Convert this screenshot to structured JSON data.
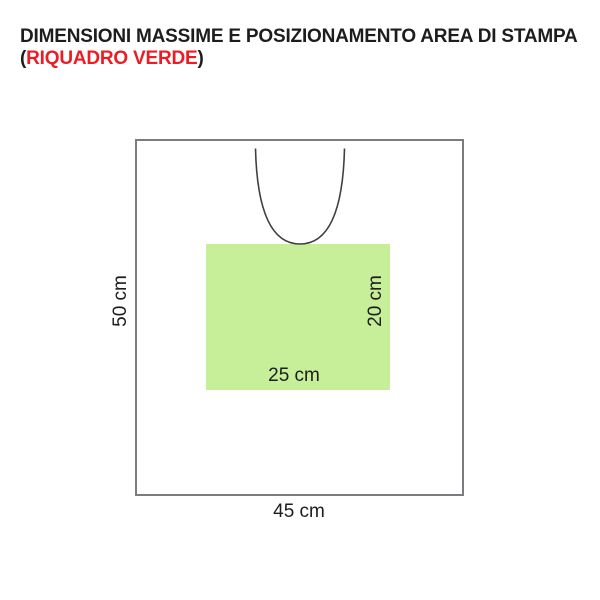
{
  "title": {
    "line1": "DIMENSIONI MASSIME E POSIZIONAMENTO AREA DI STAMPA",
    "line2_open": "(",
    "line2_highlight": "RIQUADRO VERDE",
    "line2_close": ")"
  },
  "diagram": {
    "garment_height_label": "50 cm",
    "garment_width_label": "45 cm",
    "print_area_width_label": "25 cm",
    "print_area_height_label": "20 cm"
  },
  "dimensions": {
    "garment": {
      "width_cm": 45,
      "height_cm": 50
    },
    "print_area": {
      "width_cm": 25,
      "height_cm": 20
    }
  },
  "colors": {
    "title_text": "#1d1d1b",
    "highlight_red": "#ed1c24",
    "garment_border": "#7b7c7f",
    "neckline_stroke": "#3f4042",
    "print_area_green": "#c7ef99",
    "label_text": "#1d1d1b"
  }
}
